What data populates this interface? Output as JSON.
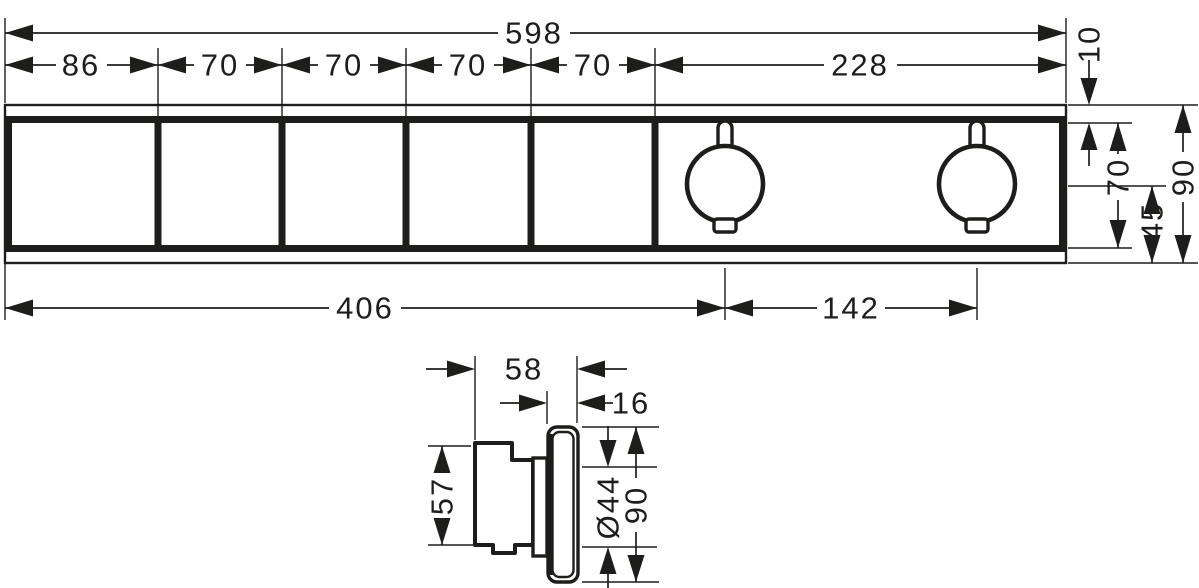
{
  "colors": {
    "background": "#ffffff",
    "line": "#1d1d1b"
  },
  "front_view": {
    "top": {
      "total": "598",
      "segments": [
        "86",
        "70",
        "70",
        "70",
        "70",
        "228"
      ]
    },
    "right": {
      "edge_offset": "10",
      "opening_height": "70",
      "center_to_bottom": "45",
      "total_height": "90"
    },
    "bottom": {
      "left_to_handle": "406",
      "handle_spacing": "142"
    }
  },
  "side_view": {
    "depth": "58",
    "plate_depth": "16",
    "body_height": "57",
    "handle_diameter": "Ø44",
    "plate_height": "90"
  }
}
